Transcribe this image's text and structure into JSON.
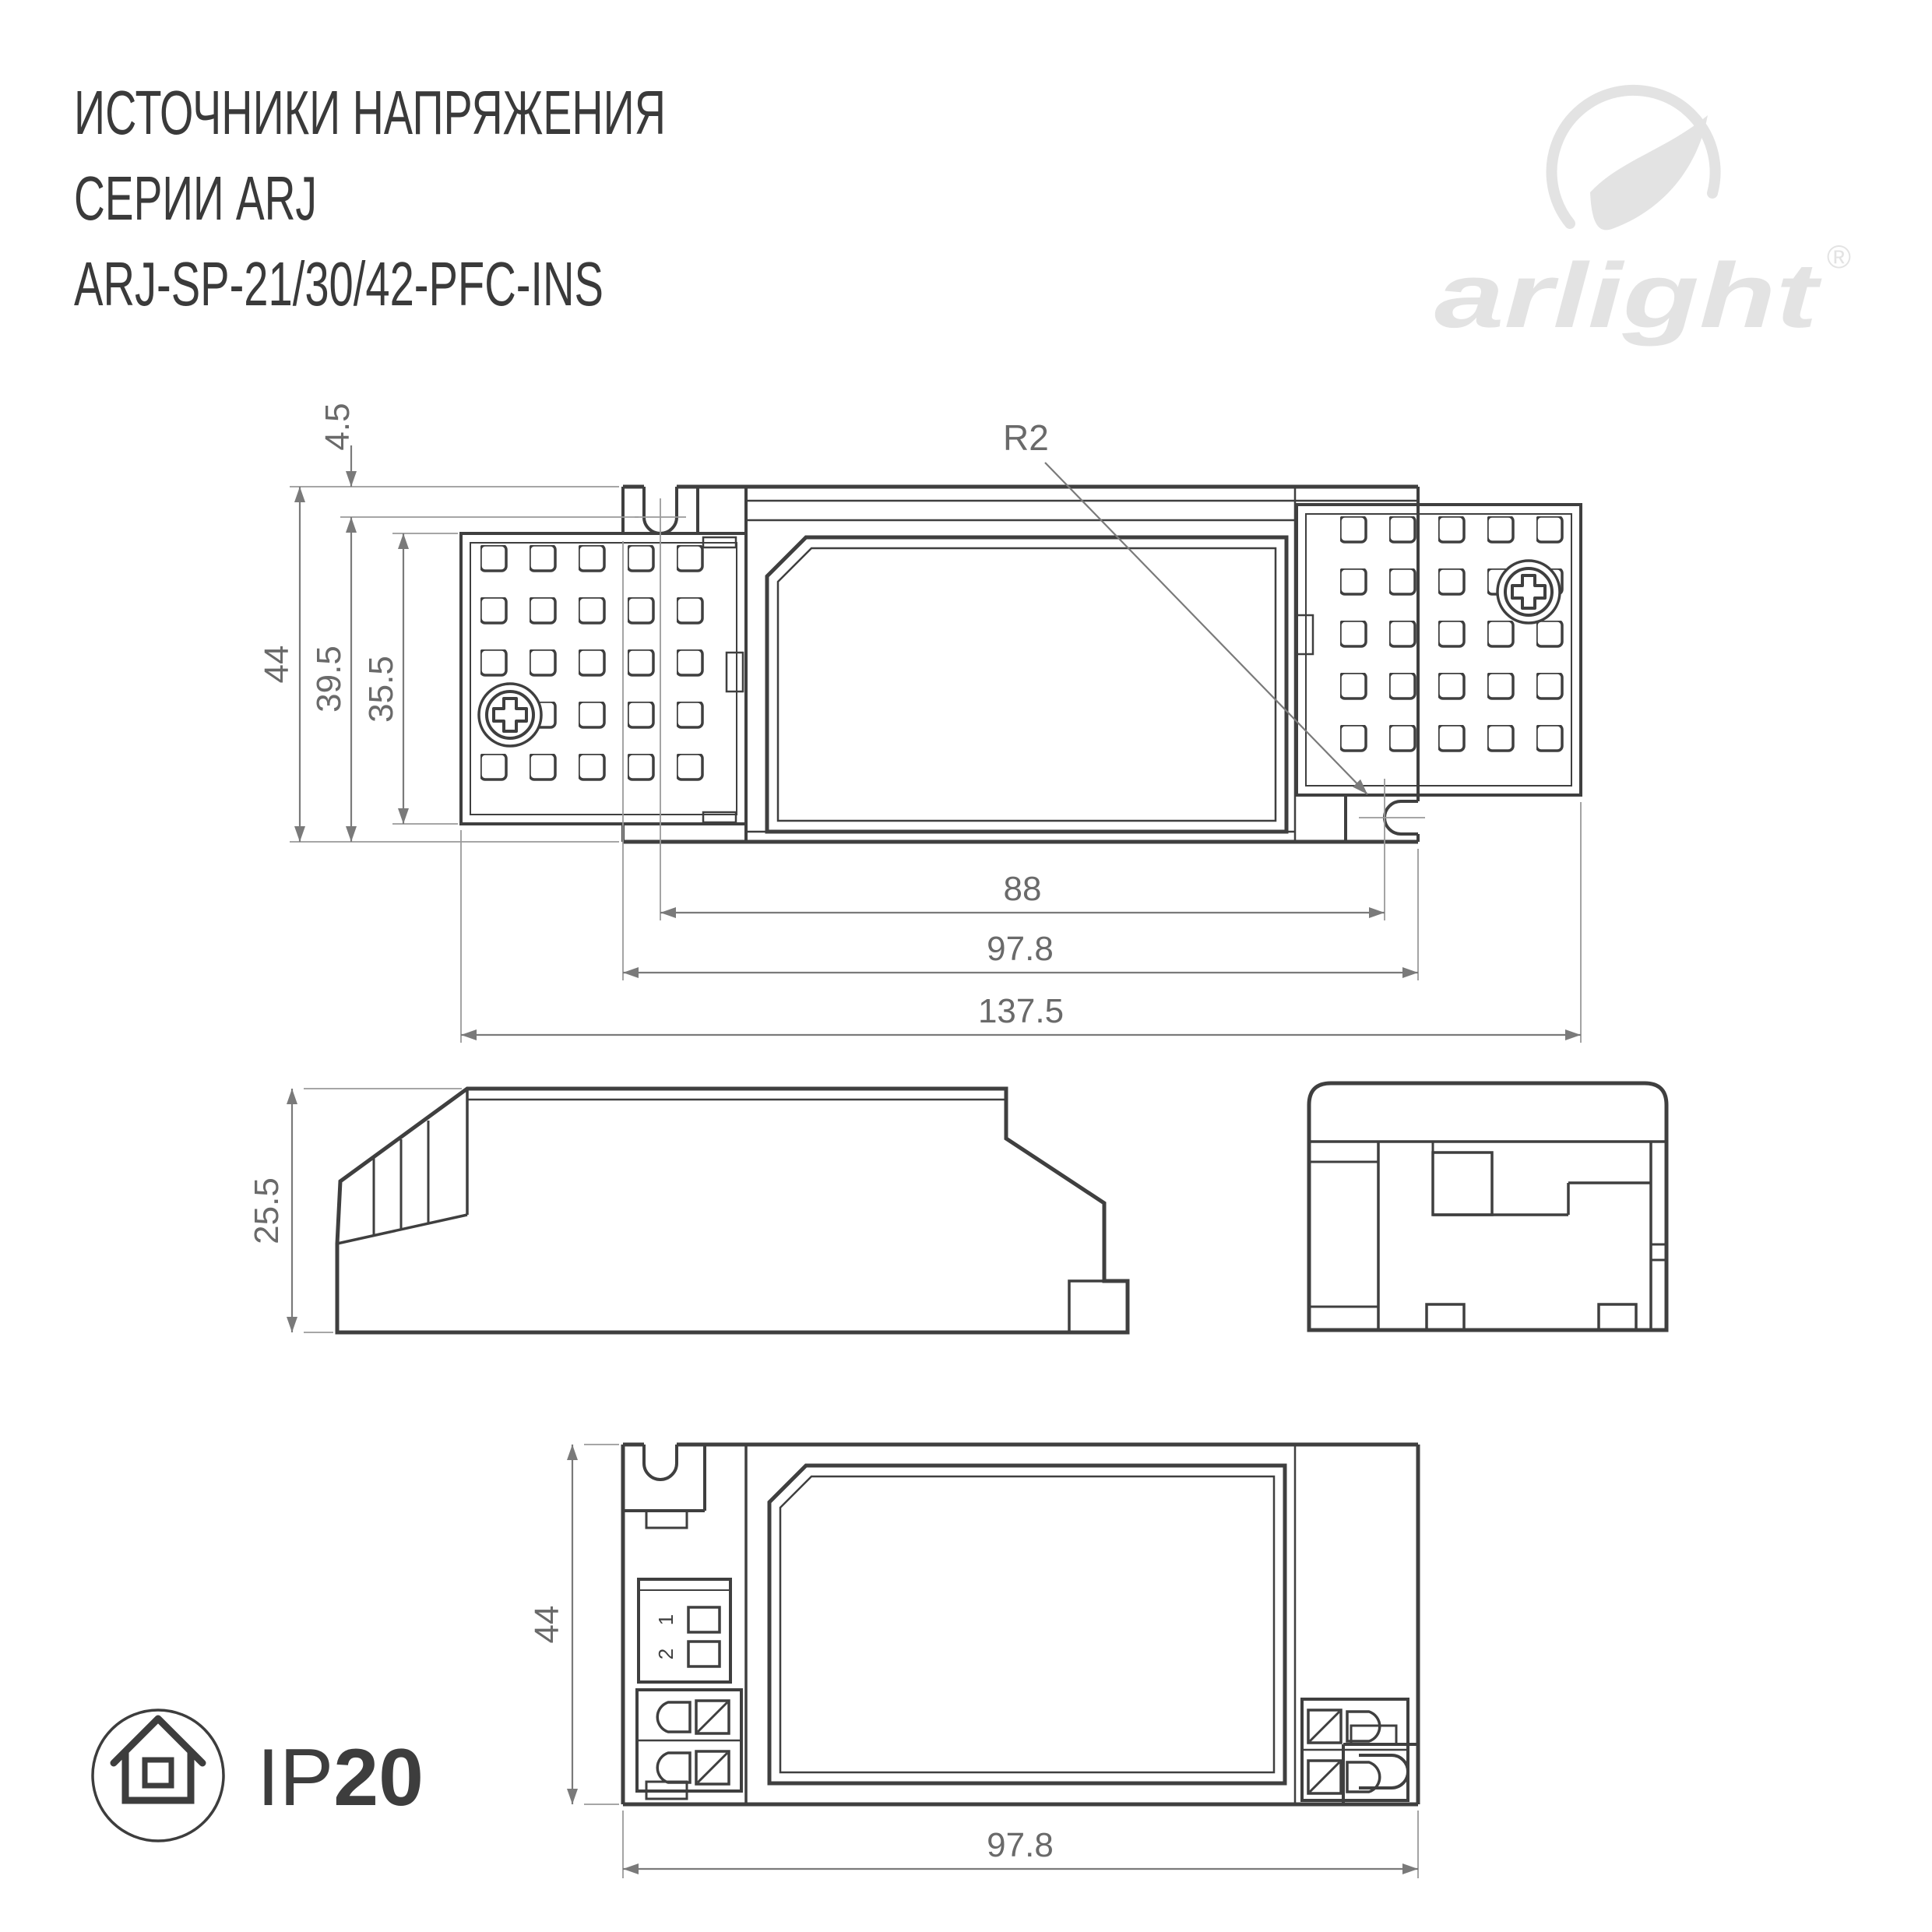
{
  "title": {
    "line1": "ИСТОЧНИКИ НАПРЯЖЕНИЯ",
    "line2": "СЕРИИ ARJ",
    "line3": "ARJ-SP-21/30/42-PFC-INS"
  },
  "logo": {
    "wordmark": "arlight",
    "registered_mark": "®"
  },
  "top_view": {
    "dim_offset_top": "4.5",
    "dim_height_total": "44",
    "dim_height_to_slot": "39.5",
    "dim_plate_height": "35.5",
    "dim_slot_spacing": "88",
    "dim_case_length": "97.8",
    "dim_total_length": "137.5",
    "slot_radius_label": "R2"
  },
  "side_view": {
    "dim_height": "25.5"
  },
  "bottom_view": {
    "dim_height": "44",
    "dim_length": "97.8",
    "dip_switch_labels": [
      "1",
      "2"
    ]
  },
  "ip_rating": {
    "prefix": "IP",
    "value": "20"
  },
  "colors": {
    "line": "#3f3f3f",
    "dim": "#7a7a7a",
    "logo": "#e3e3e3",
    "text": "#3a3a3a"
  }
}
